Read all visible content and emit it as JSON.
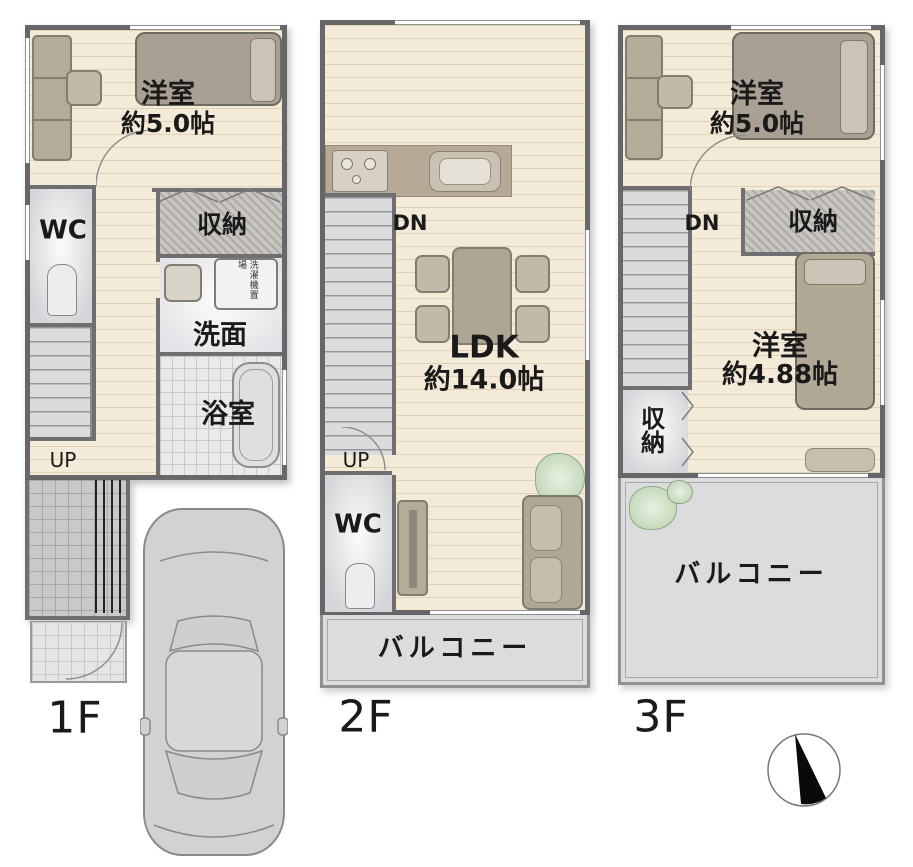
{
  "floors": [
    {
      "floor_label": "1F",
      "rooms": {
        "bedroom": {
          "name": "洋室",
          "size": "約5.0帖"
        },
        "wc": "WC",
        "closet": "収納",
        "washroom": "洗面",
        "laundry_space": "洗濯機置場",
        "bath": "浴室",
        "stairs_up": "UP"
      }
    },
    {
      "floor_label": "2F",
      "rooms": {
        "ldk": {
          "name": "LDK",
          "size": "約14.0帖"
        },
        "stairs_down": "DN",
        "stairs_up": "UP",
        "wc": "WC",
        "balcony": "バルコニー"
      }
    },
    {
      "floor_label": "3F",
      "rooms": {
        "bedroom_front": {
          "name": "洋室",
          "size": "約5.0帖"
        },
        "stairs_down": "DN",
        "closet_front": "収納",
        "bedroom_back": {
          "name": "洋室",
          "size": "約4.88帖"
        },
        "closet_side": "収納",
        "balcony": "バルコニー"
      }
    }
  ],
  "colors": {
    "floor_cream": "#f4ead8",
    "wall": "#67676a",
    "gray_room": "#d7d7db",
    "closet_hatch": "#c6c3bf",
    "balcony": "#dcdcde",
    "furniture": "#b2a997",
    "plant": "#b9d2af",
    "text": "#1a1a1a"
  }
}
